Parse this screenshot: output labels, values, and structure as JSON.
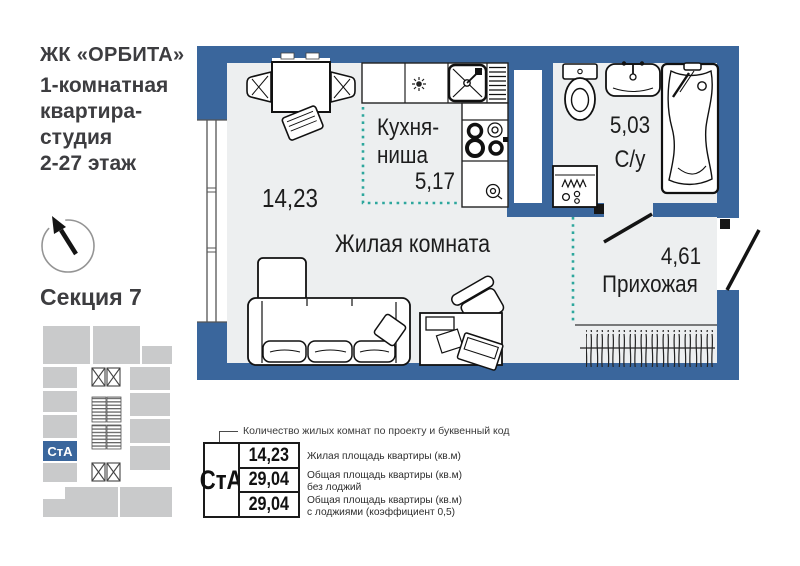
{
  "header": {
    "complex": "ЖК «ОРБИТА»",
    "subtitle_lines": [
      "1-комнатная",
      "квартира-",
      "студия",
      "2-27 этаж"
    ]
  },
  "compass": {
    "north": "С"
  },
  "section": {
    "title": "Секция 7"
  },
  "minimap": {
    "unit_code": "СтА"
  },
  "plan": {
    "rooms": {
      "living": {
        "name": "Жилая комната",
        "area": "14,23"
      },
      "kitchen": {
        "name_line1": "Кухня-",
        "name_line2": "ниша",
        "area": "5,17"
      },
      "bathroom": {
        "name": "С/у",
        "area": "5,03"
      },
      "hallway": {
        "name": "Прихожая",
        "area": "4,61"
      }
    }
  },
  "legend": {
    "note": "Количество жилых комнат по проекту и буквенный код",
    "code": "СтА",
    "rows": [
      {
        "value": "14,23",
        "desc_line1": "Жилая площадь квартиры (кв.м)",
        "desc_line2": ""
      },
      {
        "value": "29,04",
        "desc_line1": "Общая площадь квартиры (кв.м)",
        "desc_line2": "без лоджий"
      },
      {
        "value": "29,04",
        "desc_line1": "Общая площадь квартиры (кв.м)",
        "desc_line2": "с лоджиями (коэффициент 0,5)"
      }
    ]
  },
  "colors": {
    "wall_blue": "#3a669c",
    "floor": "#edeff0",
    "zoning_dotted": "#2ea79d",
    "minimap_gray": "#c9cacb"
  }
}
